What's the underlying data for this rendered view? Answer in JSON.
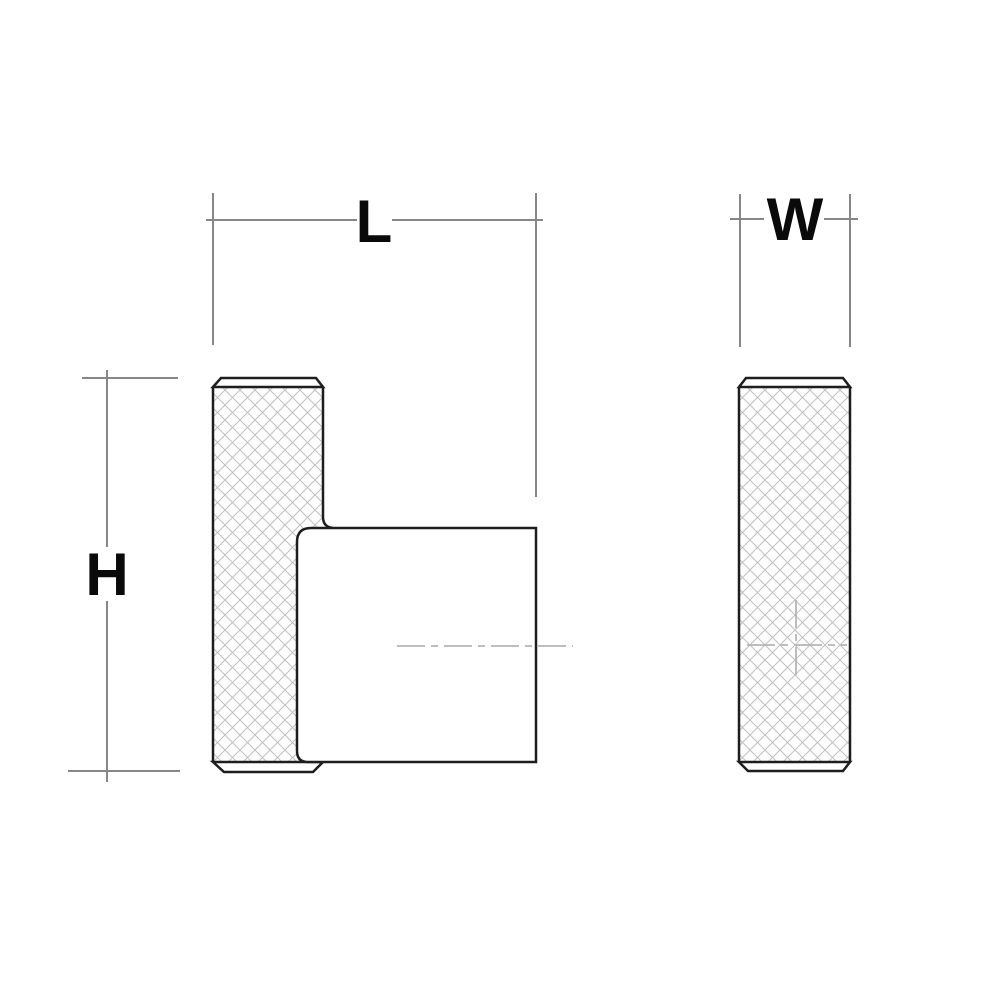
{
  "drawing": {
    "type": "technical-dimension-drawing",
    "background": "#ffffff",
    "dimension_labels": {
      "length": "L",
      "width": "W",
      "height": "H"
    },
    "colors": {
      "part_outline": "#1e1e1e",
      "dimension_line": "#878787",
      "hatch_line": "#c0c0c0",
      "centerline": "#b5b5b5",
      "label_text": "#0a0a0a",
      "fill": "#ffffff"
    }
  }
}
